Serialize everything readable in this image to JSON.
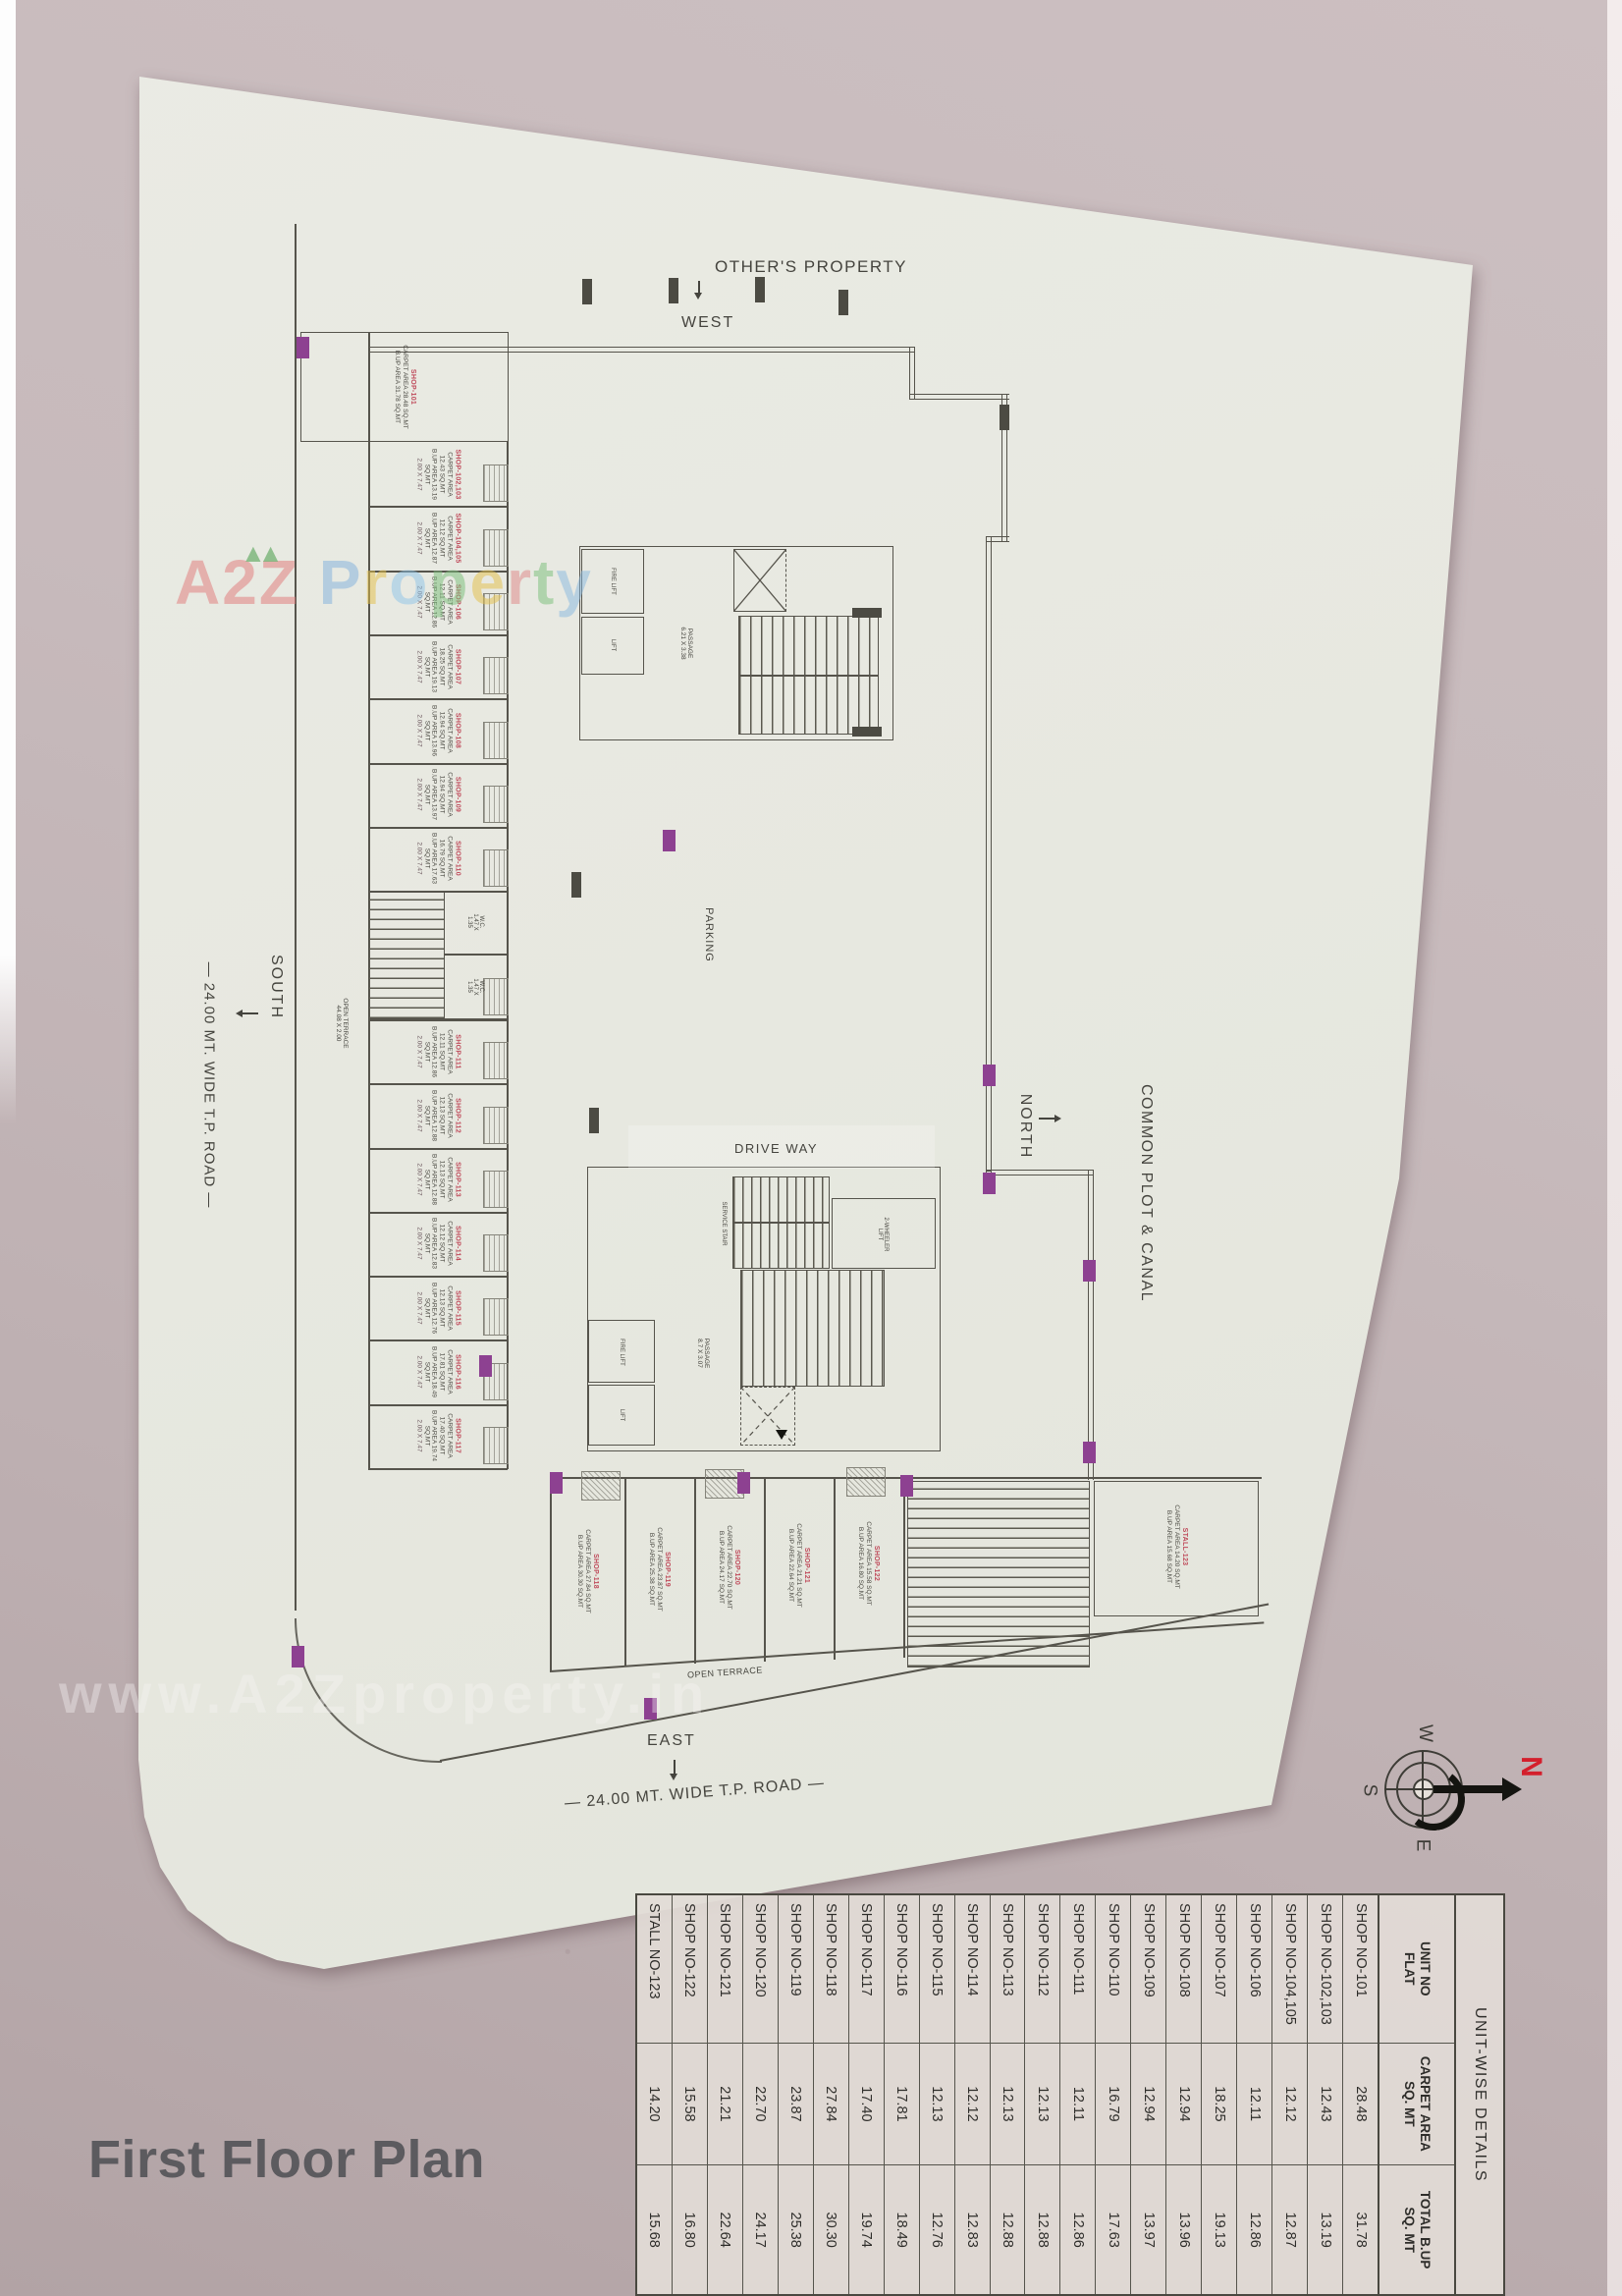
{
  "page": {
    "title": "First Floor Plan"
  },
  "labels": {
    "others_property": "OTHER'S PROPERTY",
    "west": "WEST",
    "south": "SOUTH",
    "north": "NORTH",
    "east": "EAST",
    "common_plot": "COMMON PLOT & CANAL",
    "road_left": "— 24.00 MT. WIDE T.P. ROAD —",
    "road_bottom": "— 24.00 MT. WIDE T.P. ROAD —",
    "parking": "PARKING",
    "drive_way": "DRIVE WAY",
    "open_terrace_left": "OPEN TERRACE\n44.08 X 2.00",
    "open_terrace_bottom": "OPEN TERRACE",
    "passage_upper": "PASSAGE\n6.21 X 3.38",
    "passage_lower": "PASSAGE\n8.7 X 3.07",
    "service_stair": "SERVICE STAIR",
    "two_wheeler_lift": "2-WHEELER\nLIFT",
    "fire_lift": "FIRE LIFT",
    "lift": "LIFT",
    "wc": "W.C.\n1.47 X\n1.35"
  },
  "watermark": {
    "a2z": "A2Z",
    "mountains": "▲▲",
    "property_letters": [
      {
        "ch": "P",
        "color": "rgba(125,175,220,.8)"
      },
      {
        "ch": "r",
        "color": "rgba(227,193,78,.85)"
      },
      {
        "ch": "o",
        "color": "rgba(140,195,232,.8)"
      },
      {
        "ch": "p",
        "color": "rgba(124,191,124,.85)"
      },
      {
        "ch": "e",
        "color": "rgba(227,193,78,.85)"
      },
      {
        "ch": "r",
        "color": "rgba(222,138,138,.85)"
      },
      {
        "ch": "t",
        "color": "rgba(124,191,124,.85)"
      },
      {
        "ch": "y",
        "color": "rgba(134,183,224,.8)"
      }
    ],
    "url": "www.A2Zproperty.in"
  },
  "compass": {
    "n": "N",
    "w": "W",
    "s": "S",
    "e": "E"
  },
  "table": {
    "caption": "UNIT-WISE DETAILS",
    "headers": [
      "UNIT NO\nFLAT",
      "CARPET AREA\nSQ. MT",
      "TOTAL B.UP\nSQ. MT"
    ],
    "rows": [
      {
        "unit": "SHOP NO-101",
        "carpet": "28.48",
        "bup": "31.78"
      },
      {
        "unit": "SHOP NO-102,103",
        "carpet": "12.43",
        "bup": "13.19"
      },
      {
        "unit": "SHOP NO-104,105",
        "carpet": "12.12",
        "bup": "12.87"
      },
      {
        "unit": "SHOP NO-106",
        "carpet": "12.11",
        "bup": "12.86"
      },
      {
        "unit": "SHOP NO-107",
        "carpet": "18.25",
        "bup": "19.13"
      },
      {
        "unit": "SHOP NO-108",
        "carpet": "12.94",
        "bup": "13.96"
      },
      {
        "unit": "SHOP NO-109",
        "carpet": "12.94",
        "bup": "13.97"
      },
      {
        "unit": "SHOP NO-110",
        "carpet": "16.79",
        "bup": "17.63"
      },
      {
        "unit": "SHOP NO-111",
        "carpet": "12.11",
        "bup": "12.86"
      },
      {
        "unit": "SHOP NO-112",
        "carpet": "12.13",
        "bup": "12.88"
      },
      {
        "unit": "SHOP NO-113",
        "carpet": "12.13",
        "bup": "12.88"
      },
      {
        "unit": "SHOP NO-114",
        "carpet": "12.12",
        "bup": "12.83"
      },
      {
        "unit": "SHOP NO-115",
        "carpet": "12.13",
        "bup": "12.76"
      },
      {
        "unit": "SHOP NO-116",
        "carpet": "17.81",
        "bup": "18.49"
      },
      {
        "unit": "SHOP NO-117",
        "carpet": "17.40",
        "bup": "19.74"
      },
      {
        "unit": "SHOP NO-118",
        "carpet": "27.84",
        "bup": "30.30"
      },
      {
        "unit": "SHOP NO-119",
        "carpet": "23.87",
        "bup": "25.38"
      },
      {
        "unit": "SHOP NO-120",
        "carpet": "22.70",
        "bup": "24.17"
      },
      {
        "unit": "SHOP NO-121",
        "carpet": "21.21",
        "bup": "22.64"
      },
      {
        "unit": "SHOP NO-122",
        "carpet": "15.58",
        "bup": "16.80"
      },
      {
        "unit": "STALL NO-123",
        "carpet": "14.20",
        "bup": "15.68"
      }
    ]
  },
  "plan": {
    "area_word_carpet": "CARPET AREA",
    "area_word_bup": "B.UP AREA",
    "sq_mt": "SQ.MT",
    "south_units": [
      {
        "no": "SHOP-101",
        "carpet": "28.48",
        "bup": "31.78",
        "size": ""
      },
      {
        "no": "SHOP-102,103",
        "carpet": "12.43",
        "bup": "13.19",
        "size": "2.00 X 7.47"
      },
      {
        "no": "SHOP-104,105",
        "carpet": "12.12",
        "bup": "12.87",
        "size": "2.00 X 7.47"
      },
      {
        "no": "SHOP-106",
        "carpet": "12.11",
        "bup": "12.86",
        "size": "2.00 X 7.47"
      },
      {
        "no": "SHOP-107",
        "carpet": "18.25",
        "bup": "19.13",
        "size": "2.00 X 7.47"
      },
      {
        "no": "SHOP-108",
        "carpet": "12.94",
        "bup": "13.96",
        "size": "2.00 X 7.47"
      },
      {
        "no": "SHOP-109",
        "carpet": "12.94",
        "bup": "13.97",
        "size": "2.00 X 7.47"
      },
      {
        "no": "SHOP-110",
        "carpet": "16.79",
        "bup": "17.63",
        "size": "2.00 X 7.47"
      },
      {
        "no": "SHOP-111",
        "carpet": "12.11",
        "bup": "12.86",
        "size": "2.00 X 7.47"
      },
      {
        "no": "SHOP-112",
        "carpet": "12.13",
        "bup": "12.88",
        "size": "2.00 X 7.47"
      },
      {
        "no": "SHOP-113",
        "carpet": "12.13",
        "bup": "12.88",
        "size": "2.00 X 7.47"
      },
      {
        "no": "SHOP-114",
        "carpet": "12.12",
        "bup": "12.83",
        "size": "2.00 X 7.47"
      },
      {
        "no": "SHOP-115",
        "carpet": "12.13",
        "bup": "12.76",
        "size": "2.00 X 7.47"
      },
      {
        "no": "SHOP-116",
        "carpet": "17.81",
        "bup": "18.49",
        "size": "2.00 X 7.47"
      },
      {
        "no": "SHOP-117",
        "carpet": "17.40",
        "bup": "19.74",
        "size": "2.00 X 7.47"
      }
    ],
    "east_units": [
      {
        "no": "SHOP-118",
        "carpet": "27.84",
        "bup": "30.30"
      },
      {
        "no": "SHOP-119",
        "carpet": "23.87",
        "bup": "25.38"
      },
      {
        "no": "SHOP-120",
        "carpet": "22.70",
        "bup": "24.17"
      },
      {
        "no": "SHOP-121",
        "carpet": "21.21",
        "bup": "22.64"
      },
      {
        "no": "SHOP-122",
        "carpet": "15.58",
        "bup": "16.80"
      },
      {
        "no": "STALL-123",
        "carpet": "14.20",
        "bup": "15.68"
      }
    ]
  },
  "colors": {
    "accent_purple": "#8d4191",
    "shop_label_red": "#bf4a5a",
    "line": "#56544c",
    "paper": "#e8e9e1"
  }
}
